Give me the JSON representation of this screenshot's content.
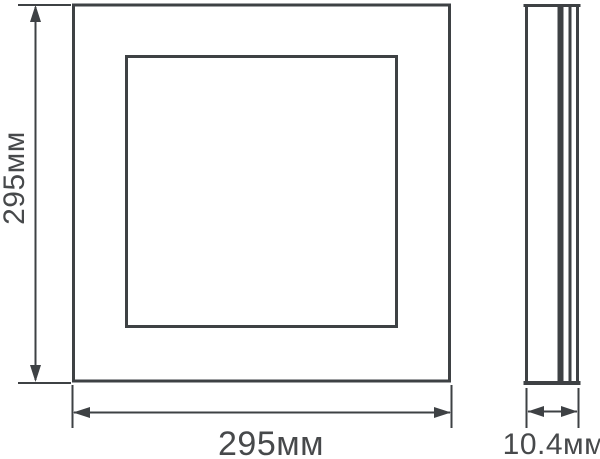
{
  "drawing": {
    "type": "technical-dimension-drawing",
    "colors": {
      "line": "#3e4144",
      "text": "#47494b",
      "background": "#ffffff"
    },
    "dimensions": {
      "height": "295мм",
      "width": "295мм",
      "depth": "10.4мм"
    }
  }
}
